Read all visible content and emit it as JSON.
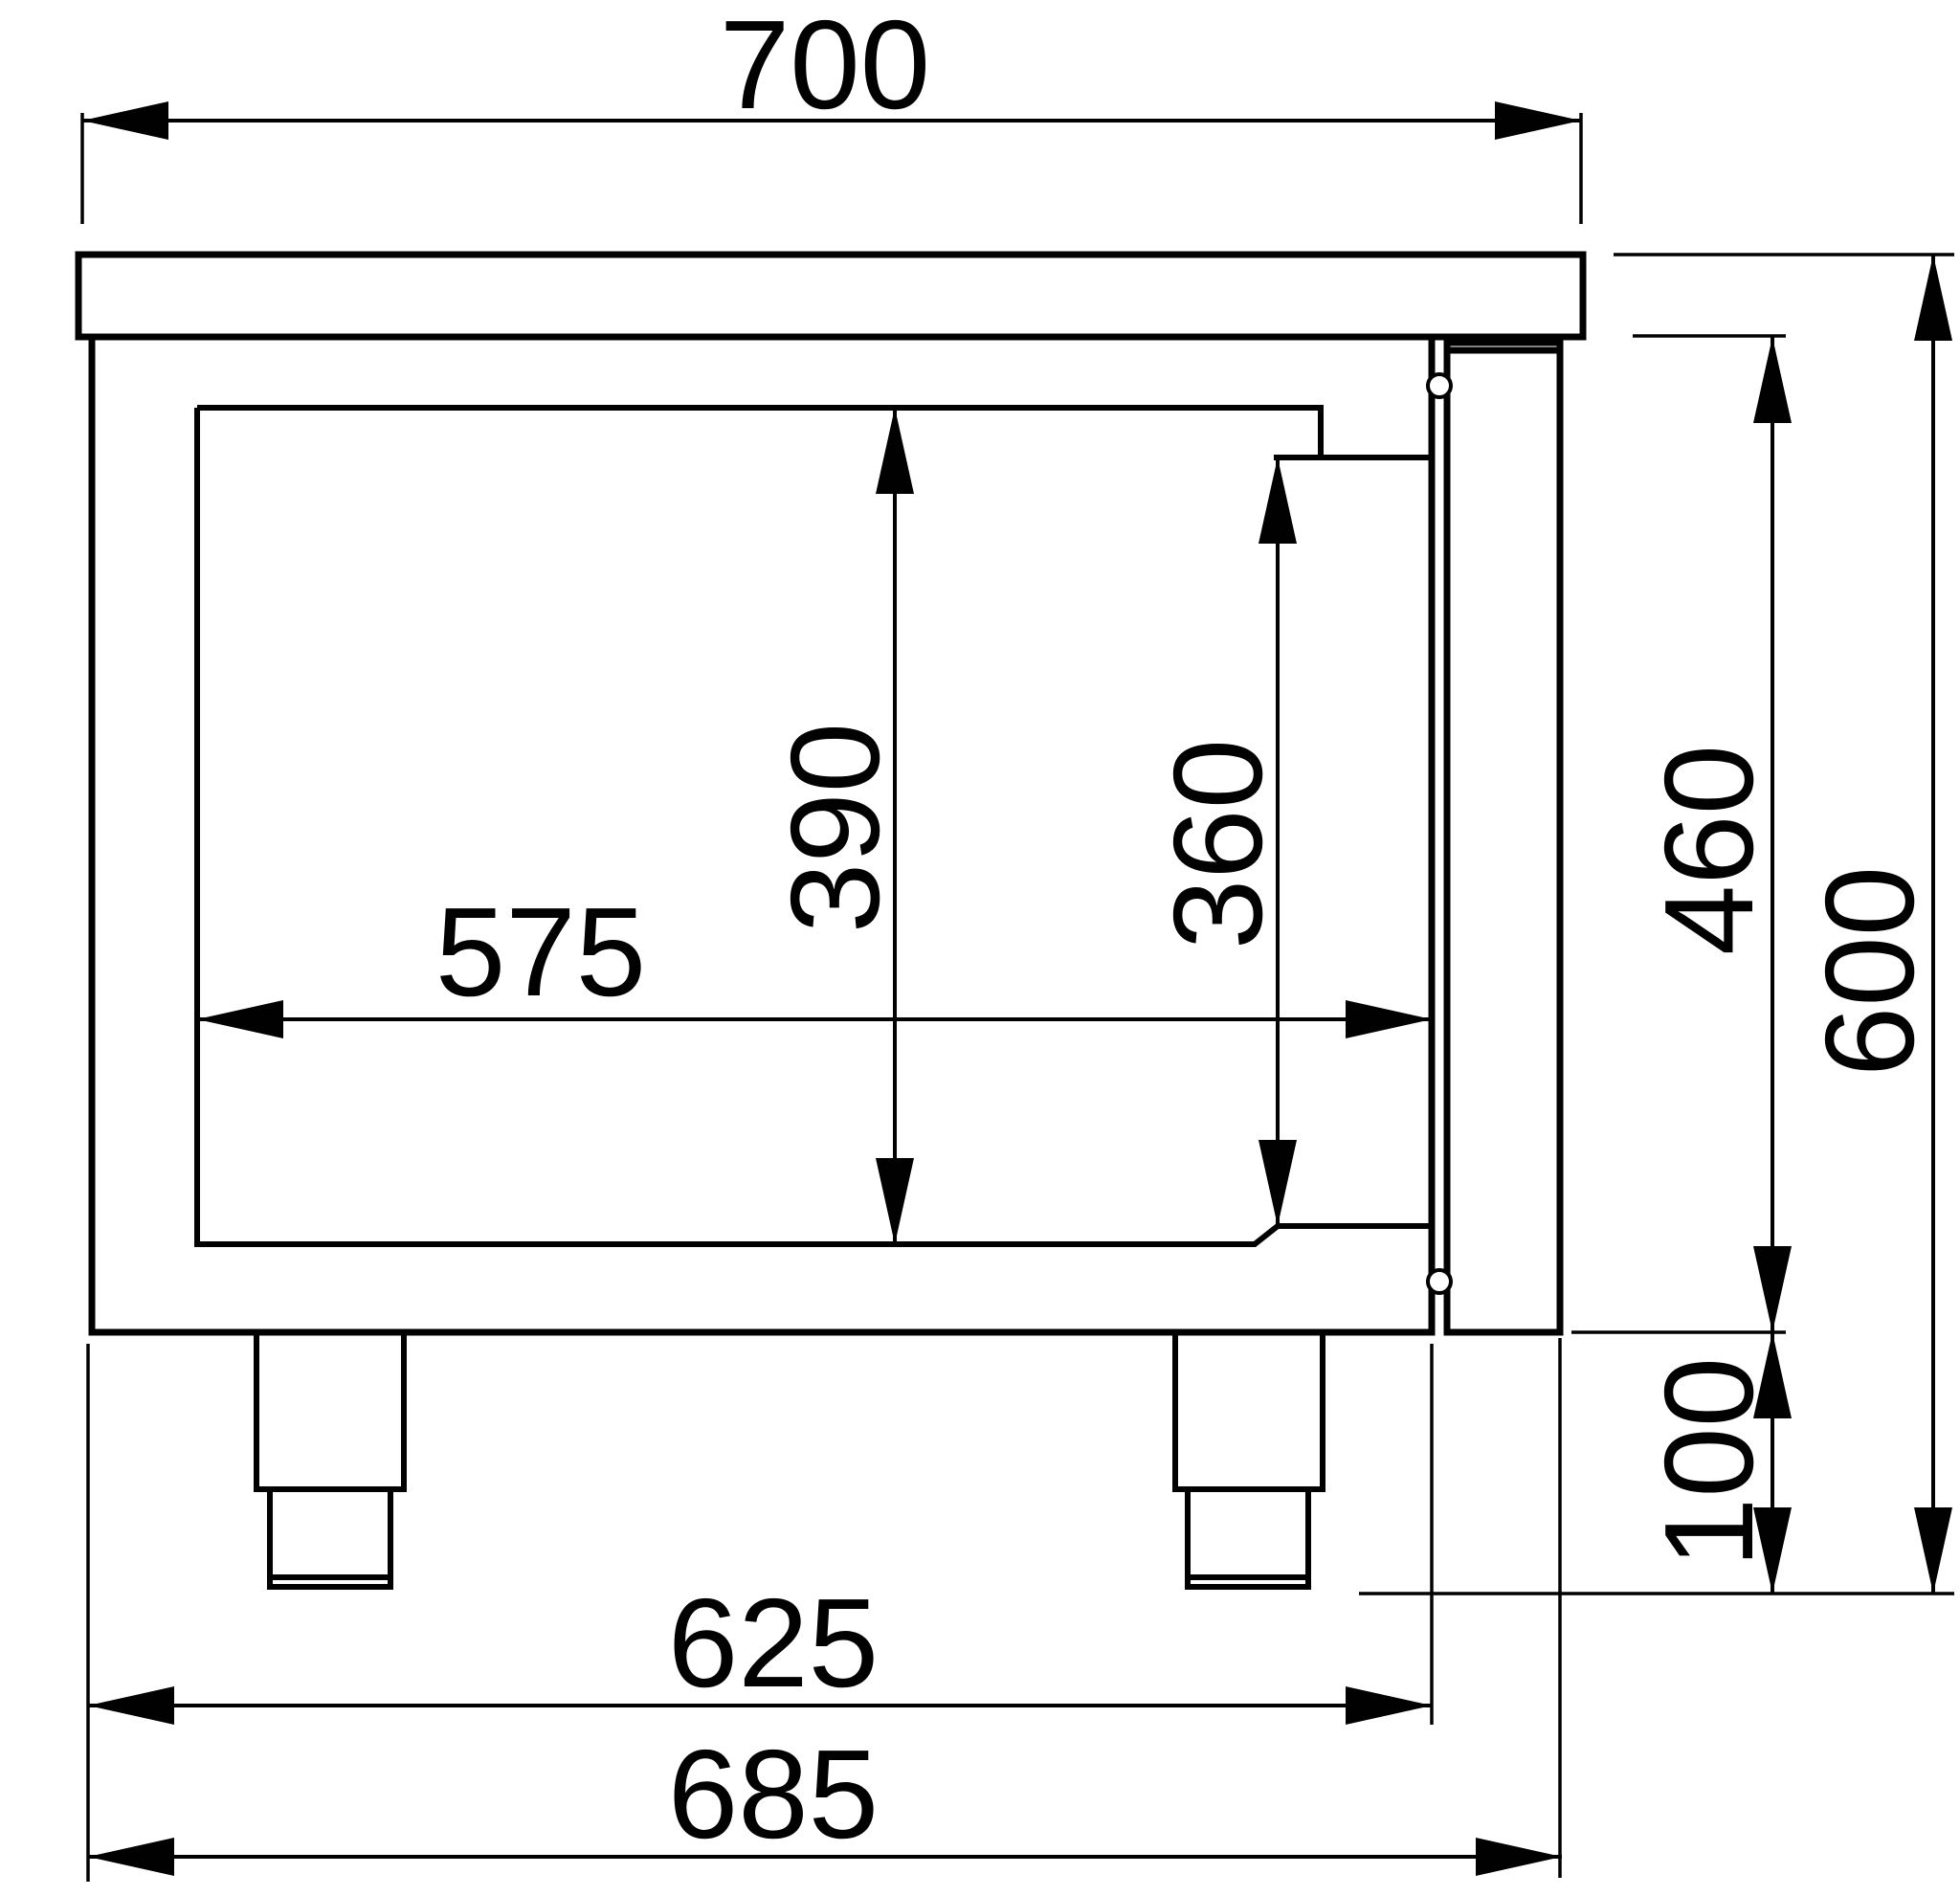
{
  "drawing": {
    "dimension_labels": {
      "top_depth": "700",
      "inner_depth": "575",
      "inner_height": "390",
      "inner_height_step": "360",
      "door_height": "460",
      "overall_height": "600",
      "leg_height": "100",
      "body_depth": "625",
      "body_with_door_depth": "685"
    }
  }
}
